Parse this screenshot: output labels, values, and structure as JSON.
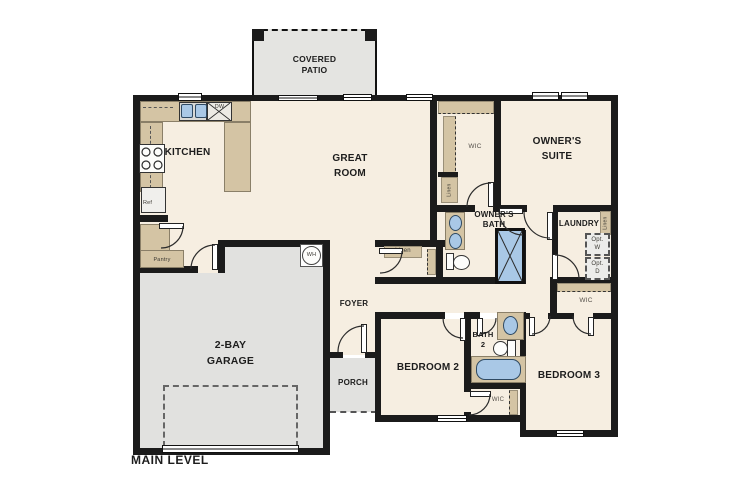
{
  "plan": {
    "level_label": "MAIN LEVEL",
    "rooms": {
      "covered_patio": "COVERED\nPATIO",
      "kitchen": "KITCHEN",
      "great_room": "GREAT\nROOM",
      "owners_suite": "OWNER'S\nSUITE",
      "owners_bath": "OWNER'S\nBATH",
      "laundry": "LAUNDRY",
      "foyer": "FOYER",
      "porch": "PORCH",
      "garage": "2-BAY\nGARAGE",
      "bedroom2": "BEDROOM 2",
      "bedroom3": "BEDROOM 3",
      "bath2": "BATH\n2"
    },
    "closets": {
      "wic_owner": "WIC",
      "wic_bed2": "WIC",
      "wic_bed3": "WIC",
      "linen_hall": "Linen",
      "linen_owner": "Linen",
      "linen_laundry": "Linen",
      "pantry": "Pantry"
    },
    "appliances": {
      "refrigerator": "Ref",
      "dishwasher": "DW",
      "water_heater": "WH",
      "washer_opt": "Opt.\nW",
      "dryer_opt": "Opt.\nD"
    },
    "colors": {
      "wall": "#1b1b1b",
      "floor_cream": "#f6eee1",
      "cabinet_tan": "#d4c4a4",
      "exterior_gray": "#e1e1df",
      "fixture_blue": "#a9c8e6"
    }
  }
}
